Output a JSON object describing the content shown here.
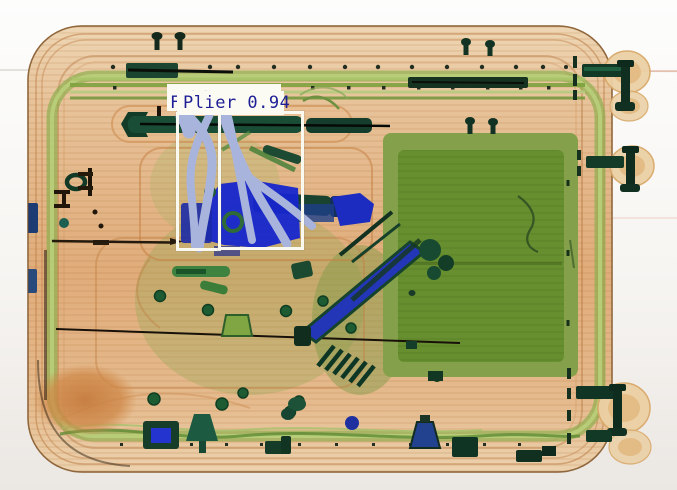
{
  "scene": {
    "kind": "xray-baggage-scan",
    "description": "Dual-energy X-ray scan of a suitcase containing tools; organic material shown green/orange, metal shown blue/dark green",
    "detected_object": "pliers with light blue-grey crossed handles inside two white detection boxes"
  },
  "detections": {
    "primary": {
      "class_name": "Plier",
      "confidence": "0.94",
      "label_text": "Plier 0.94"
    },
    "occluded_fragment": "F",
    "phantom_marks": "··"
  },
  "colors": {
    "label_text": "#1e1e96",
    "label_background": "#fbfbf3",
    "box_border": "#f9f9f0",
    "background_top": "#fdfdfc",
    "background_bottom": "#ebe7e3",
    "case_body_tan": "#e2b184",
    "case_edge": "#b98d5c",
    "organic_green_panel": "#678e2f",
    "frame_band_green": "#8fae4f",
    "metal_bright_blue": "#1626cd",
    "metal_dark_green": "#14432e",
    "plier_metal_lavender": "#a9b4dc",
    "dense_orange_blob": "#cf8848"
  }
}
